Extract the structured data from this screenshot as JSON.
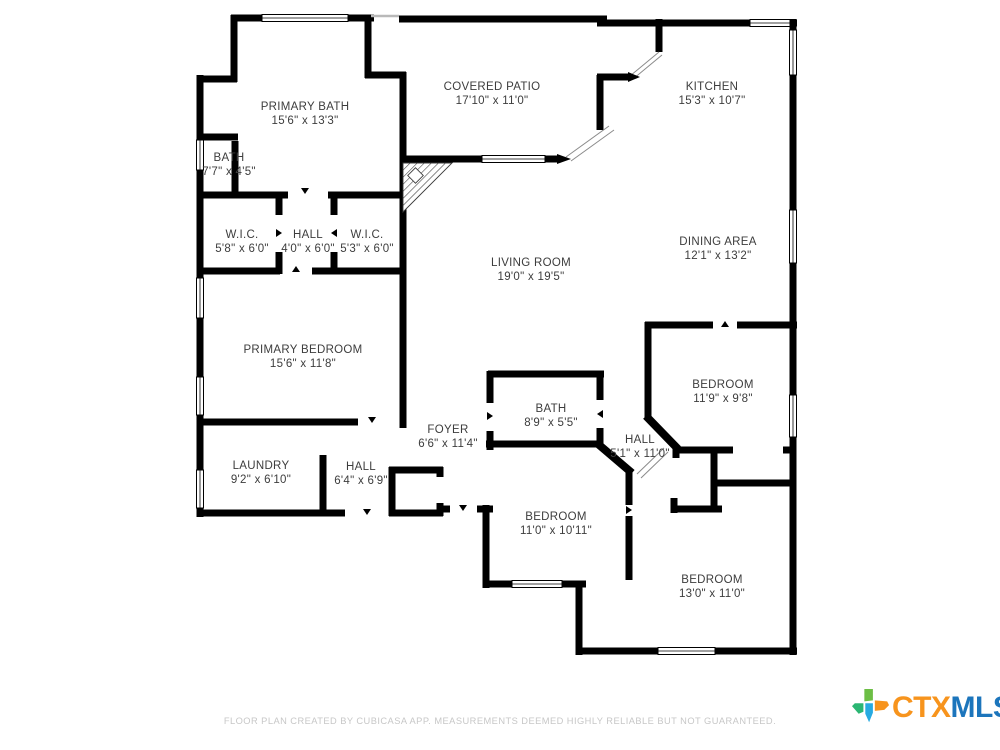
{
  "floor_plan": {
    "rooms": [
      {
        "name": "PRIMARY BATH",
        "dims": "15'6\" x 13'3\""
      },
      {
        "name": "BATH",
        "dims": "7'7\" x 4'5\""
      },
      {
        "name": "COVERED PATIO",
        "dims": "17'10\" x 11'0\""
      },
      {
        "name": "KITCHEN",
        "dims": "15'3\" x 10'7\""
      },
      {
        "name": "W.I.C.",
        "dims": "5'8\" x 6'0\""
      },
      {
        "name": "HALL",
        "dims": "4'0\" x 6'0\""
      },
      {
        "name": "W.I.C.",
        "dims": "5'3\" x 6'0\""
      },
      {
        "name": "LIVING ROOM",
        "dims": "19'0\" x 19'5\""
      },
      {
        "name": "DINING AREA",
        "dims": "12'1\" x 13'2\""
      },
      {
        "name": "PRIMARY BEDROOM",
        "dims": "15'6\" x 11'8\""
      },
      {
        "name": "BEDROOM",
        "dims": "11'9\" x 9'8\""
      },
      {
        "name": "FOYER",
        "dims": "6'6\" x 11'4\""
      },
      {
        "name": "BATH",
        "dims": "8'9\" x 5'5\""
      },
      {
        "name": "HALL",
        "dims": "5'1\" x 11'0\""
      },
      {
        "name": "LAUNDRY",
        "dims": "9'2\" x 6'10\""
      },
      {
        "name": "HALL",
        "dims": "6'4\" x 6'9\""
      },
      {
        "name": "BEDROOM",
        "dims": "11'0\" x 10'11\""
      },
      {
        "name": "BEDROOM",
        "dims": "13'0\" x 11'0\""
      }
    ],
    "footer": "FLOOR PLAN CREATED BY CUBICASA APP. MEASUREMENTS DEEMED HIGHLY RELIABLE BUT NOT GUARANTEED.",
    "logo": {
      "ctx": "CTX",
      "mls": "MLS",
      "ctx_color": "#F7941D",
      "mls_color": "#1C75BC",
      "icon": "texas-state-icon",
      "icon_colors": [
        "#6CBE45",
        "#F7941D",
        "#2BB673",
        "#27AAE1"
      ]
    },
    "colors": {
      "wall": "#000000",
      "label_text": "#3d3d3d",
      "footer_text": "#c7c7c7",
      "background": "#ffffff"
    }
  }
}
